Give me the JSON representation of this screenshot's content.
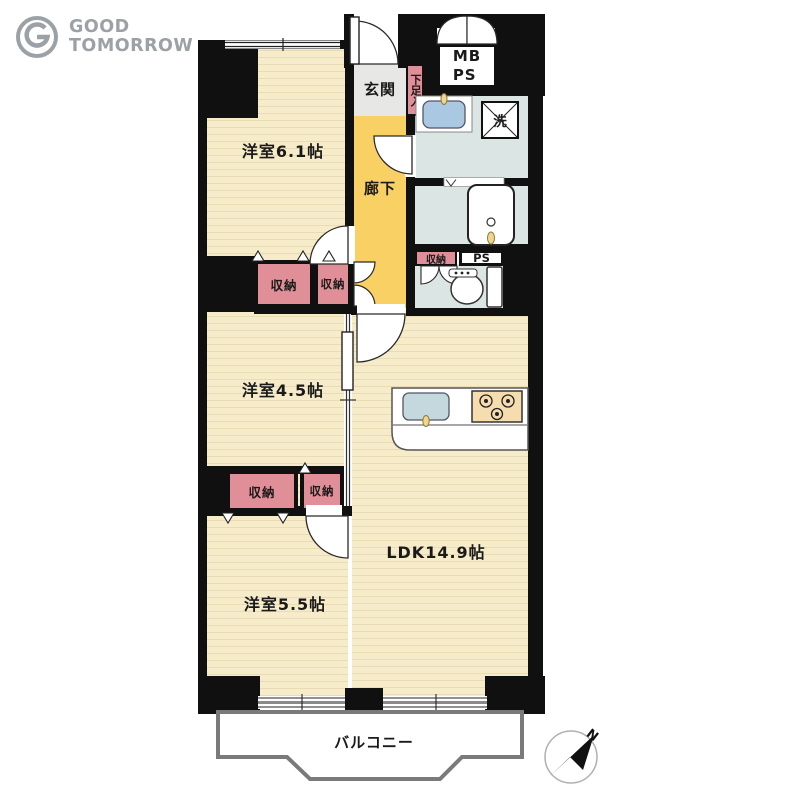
{
  "logo": {
    "line1": "GOOD",
    "line2": "TOMORROW"
  },
  "plan": {
    "room_labels": {
      "bedroom_61": "洋室6.1帖",
      "bedroom_45": "洋室4.5帖",
      "bedroom_55": "洋室5.5帖",
      "ldk": "LDK14.9帖",
      "entrance": "玄関",
      "hallway": "廊下",
      "balcony": "バルコニー",
      "shoe_cabinet": "下足入"
    },
    "closet_labels": {
      "c1": "収納",
      "c2": "収納",
      "c3": "収納",
      "c4": "収納",
      "c5": "収納"
    },
    "utility_labels": {
      "meter_box": "MB",
      "pipe_space_upper": "PS",
      "pipe_space_lower": "PS",
      "washing_machine": "洗"
    },
    "compass": {
      "north": "N"
    },
    "colors": {
      "wall": "#101010",
      "wood_floor": "#f6ecca",
      "hallway_yellow": "#f9d063",
      "entrance_gray": "#e7e7e5",
      "closet_pink": "#e08e97",
      "wet_area_blue": "#dbe5e3",
      "sink_blue": "#abc8e2",
      "stove_beige": "#f6ddb0",
      "balcony_outline": "#7a7a7a",
      "logo_gray": "#9ca1a5"
    }
  }
}
